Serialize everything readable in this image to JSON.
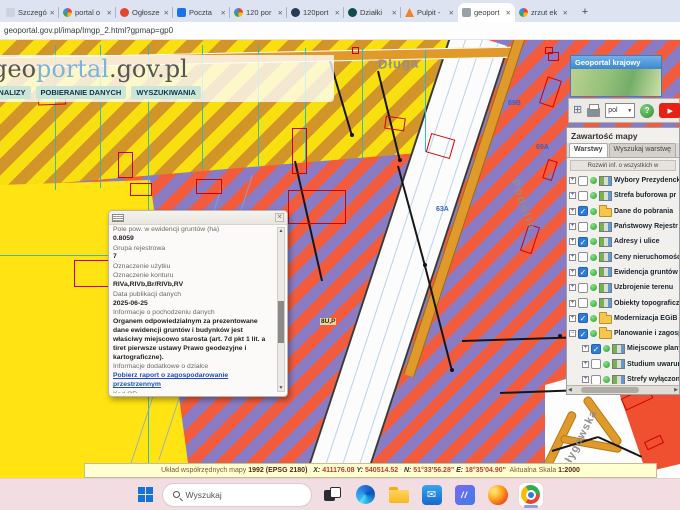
{
  "browser": {
    "tabs": [
      {
        "title": "Szczegó",
        "fav": "none"
      },
      {
        "title": "portal o",
        "fav": "g"
      },
      {
        "title": "Ogłosze",
        "fav": "red"
      },
      {
        "title": "Poczta",
        "fav": "mail"
      },
      {
        "title": "120 por",
        "fav": "g"
      },
      {
        "title": "120port",
        "fav": "globe"
      },
      {
        "title": "Działki",
        "fav": "dark"
      },
      {
        "title": "Pulpit -",
        "fav": "orange"
      },
      {
        "title": "geoport",
        "fav": "geo",
        "active": true
      },
      {
        "title": "zrzut ek",
        "fav": "g"
      }
    ],
    "new_tab_label": "+",
    "url": "geoportal.gov.pl/imap/Imgp_2.html?gpmap=gp0"
  },
  "branding": {
    "logo_prefix": "geo",
    "logo_mid": "portal",
    "logo_suffix": ".gov.pl",
    "menu": [
      "ANALIZY",
      "POBIERANIE DANYCH",
      "WYSZUKIWANIA"
    ]
  },
  "map": {
    "labels": {
      "street_top": "Długa",
      "street_right": "Podolin",
      "street_bottom": "Gołygowska",
      "parcel_a": "63A",
      "parcel_b": "69A",
      "parcel_c": "89B",
      "zone_code": "8U,P"
    }
  },
  "popup": {
    "close": "✕",
    "rows": [
      {
        "kind": "label",
        "text": "Pole pow. w ewidencji gruntów (ha)"
      },
      {
        "kind": "value",
        "text": "0.8059"
      },
      {
        "kind": "label",
        "text": "Grupa rejestrowa"
      },
      {
        "kind": "value",
        "text": "7"
      },
      {
        "kind": "label",
        "text": "Oznaczenie użytku"
      },
      {
        "kind": "label",
        "text": "Oznaczenie konturu"
      },
      {
        "kind": "value",
        "text": "RIVa,RIVb,Br/RIVb,RV"
      },
      {
        "kind": "label",
        "text": "Data publikacji danych"
      },
      {
        "kind": "value",
        "text": "2025-06-25"
      },
      {
        "kind": "label",
        "text": "Informacje o pochodzeniu danych"
      },
      {
        "kind": "value",
        "text": "Organem odpowiedzialnym za prezentowane dane ewidencji gruntów i budynków jest właściwy miejscowo starosta (art. 7d pkt 1 lit. a tiret pierwsze ustawy Prawo geodezyjne i kartograficzne)."
      },
      {
        "kind": "label",
        "text": "Informacje dodatkowe o działce"
      },
      {
        "kind": "link",
        "text": "Pobierz raport o zagospodarowanie przestrzennym"
      },
      {
        "kind": "label",
        "text": "Kod QR"
      }
    ]
  },
  "sidebar": {
    "minimap_title": "Geoportal krajowy",
    "toolbar": {
      "language": "pol",
      "help": "?"
    },
    "panel_title": "Zawartość mapy",
    "tabs": [
      "Warstwy",
      "Wyszukaj warstwę"
    ],
    "expand_all": "Rozwiń inf. o wszystkich w",
    "layers": [
      {
        "label": "Wybory Prezydenck",
        "checked": false,
        "icon": "layer"
      },
      {
        "label": "Strefa buforowa pr",
        "checked": false,
        "icon": "layer"
      },
      {
        "label": "Dane do pobrania",
        "checked": true,
        "icon": "folder"
      },
      {
        "label": "Państwowy Rejestr",
        "checked": false,
        "icon": "layer"
      },
      {
        "label": "Adresy i ulice",
        "checked": true,
        "icon": "layer"
      },
      {
        "label": "Ceny nieruchomośc",
        "checked": false,
        "icon": "layer"
      },
      {
        "label": "Ewidencja gruntów",
        "checked": true,
        "icon": "layer"
      },
      {
        "label": "Uzbrojenie terenu",
        "checked": false,
        "icon": "layer"
      },
      {
        "label": "Obiekty topograficz",
        "checked": false,
        "icon": "layer"
      },
      {
        "label": "Modernizacja EGiB",
        "checked": true,
        "icon": "folder"
      },
      {
        "label": "Planowanie i zagospodar",
        "checked": true,
        "icon": "folder",
        "expanded": true
      },
      {
        "label": "Miejscowe plany",
        "checked": true,
        "icon": "layer",
        "indent": true
      },
      {
        "label": "Studium uwarun",
        "checked": false,
        "icon": "layer",
        "indent": true
      },
      {
        "label": "Strefy wyłączon",
        "checked": false,
        "icon": "layer",
        "indent": true
      }
    ]
  },
  "statusbar": {
    "segments": [
      {
        "text": "Układ współrzędnych mapy ",
        "cls": "lbl"
      },
      {
        "text": "1992 (EPSG 2180)",
        "cls": "strong"
      },
      {
        "text": "   X: ",
        "cls": "key"
      },
      {
        "text": "411176.08 ",
        "cls": "val"
      },
      {
        "text": "Y: ",
        "cls": "key"
      },
      {
        "text": "540514.52",
        "cls": "val"
      },
      {
        "text": "   N: ",
        "cls": "key"
      },
      {
        "text": "51°33'56.28\" ",
        "cls": "val"
      },
      {
        "text": "E: ",
        "cls": "key"
      },
      {
        "text": "18°35'04.90\"",
        "cls": "val"
      },
      {
        "text": "  Aktualna Skala ",
        "cls": "lbl"
      },
      {
        "text": "1:2000",
        "cls": "strong"
      }
    ]
  },
  "taskbar": {
    "search_placeholder": "Wyszukaj",
    "movies_glyph": "//",
    "mail_glyph": "✉"
  },
  "colors": {
    "accent_blue": "#2f7cd6",
    "map_yellow": "#ffe312",
    "map_orange": "#d2952a",
    "map_purple": "#8a7cc4",
    "map_red_stripe": "#f25c3c",
    "status_bg": "#ffffd2",
    "taskbar_bg": "#f1dde2"
  }
}
